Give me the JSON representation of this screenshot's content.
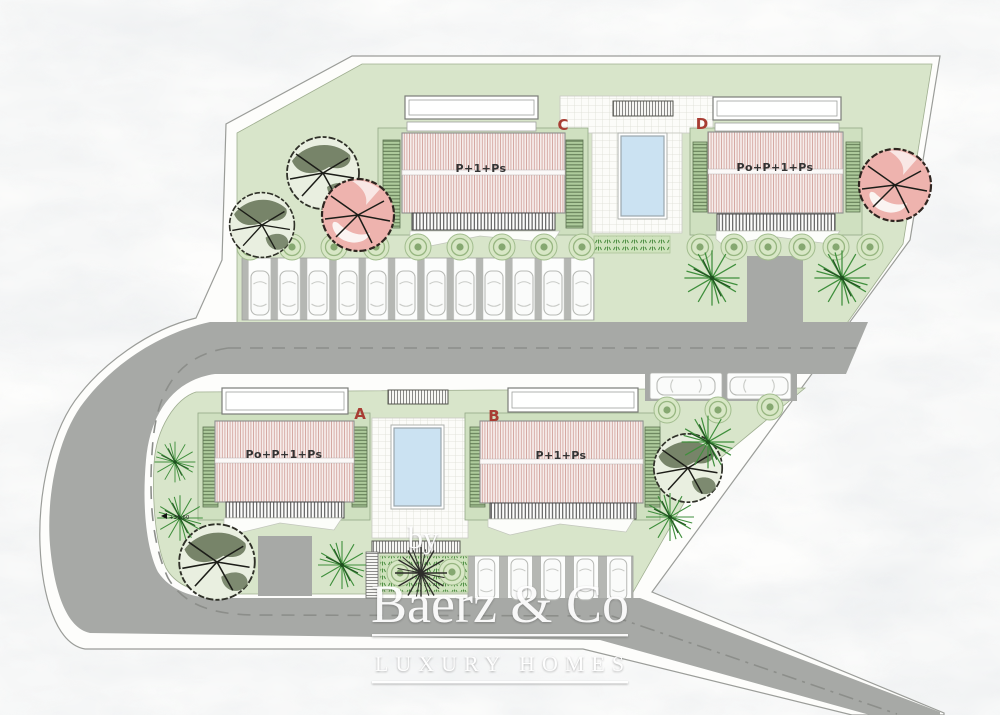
{
  "plan": {
    "title_hint": "residential site plan",
    "buildings": [
      {
        "id": "A",
        "floors_label": "Po+P+1+Ps"
      },
      {
        "id": "B",
        "floors_label": "P+1+Ps"
      },
      {
        "id": "C",
        "floors_label": "P+1+Ps"
      },
      {
        "id": "D",
        "floors_label": "Po+P+1+Ps"
      }
    ],
    "elevation_marker": "+35.60",
    "colors": {
      "lawn_green": "#d8e5ca",
      "louver_green": "#aecb9c",
      "road_gray": "#a7a9a6",
      "pool_blue": "#cbe2f2",
      "roof_stripe_pink": "#d2a29c",
      "letter_red": "#a83d33",
      "tree_olive": "#6a785c",
      "tree_pink": "#eeb3ae",
      "tree_bright_green": "#3f8f3c"
    }
  },
  "watermark": {
    "prefix": "by",
    "brand": "Baerz & Co",
    "tagline": "LUXURY HOMES"
  }
}
